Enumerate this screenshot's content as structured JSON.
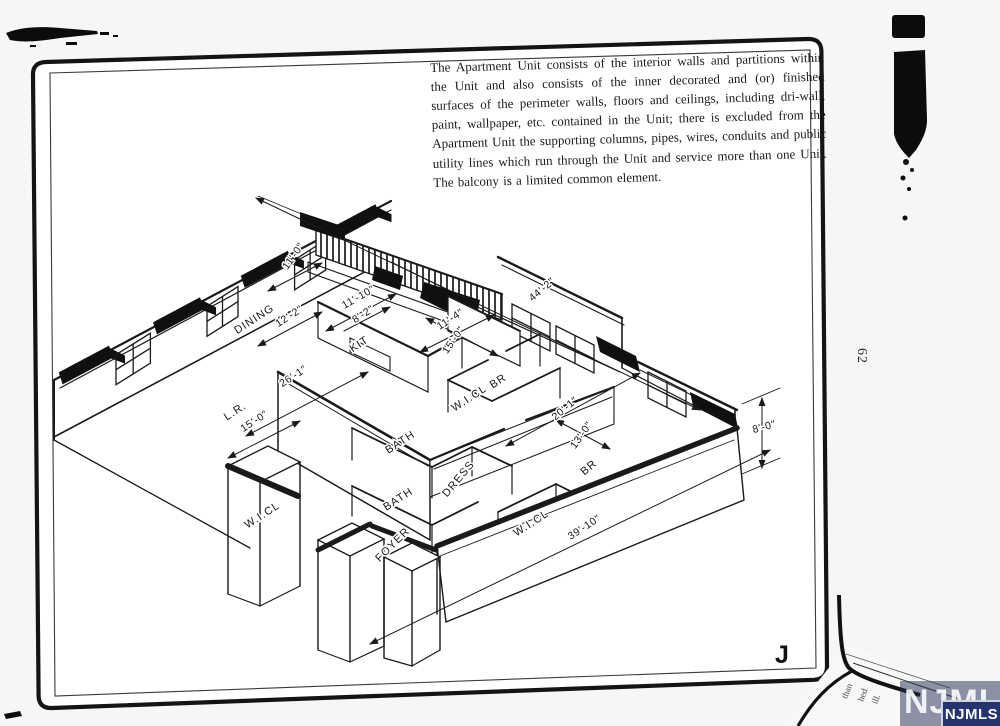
{
  "page": {
    "paragraph": "The Apartment Unit consists of the interior walls and partitions within the Unit and also consists of the inner decorated and (or) finished surfaces of the perimeter walls, floors and ceilings, including dri-wall, paint, wallpaper, etc. contained in the Unit; there is excluded from the Apartment Unit the supporting columns, pipes, wires, conduits and public utility lines which run through the Unit and service more than one Unit. The balcony is a limited common element.",
    "figure_label": "J",
    "page_number": "62"
  },
  "watermark": {
    "text": "NJMLS",
    "badge_color": "#25346e"
  },
  "overlap": {
    "fragments": [
      "than",
      "hed",
      "ill."
    ]
  },
  "plan": {
    "rooms": [
      {
        "text": "DINING"
      },
      {
        "text": "KIT"
      },
      {
        "text": "L.R."
      },
      {
        "text": "BR"
      },
      {
        "text": "W.I.CL"
      },
      {
        "text": "BATH"
      },
      {
        "text": "BATH"
      },
      {
        "text": "DRESS"
      },
      {
        "text": "FOYER"
      },
      {
        "text": "W.I.CL"
      },
      {
        "text": "BR"
      },
      {
        "text": "W.I.CL"
      }
    ],
    "dims": [
      {
        "text": "12'-2\""
      },
      {
        "text": "11'-10\""
      },
      {
        "text": "8'-2\""
      },
      {
        "text": "11'-0\""
      },
      {
        "text": "26'-1\""
      },
      {
        "text": "15'-0\""
      },
      {
        "text": "11'-4\""
      },
      {
        "text": "15'-0\""
      },
      {
        "text": "44'-2\""
      },
      {
        "text": "20'-1\""
      },
      {
        "text": "13'-0\""
      },
      {
        "text": "39'-10\""
      },
      {
        "text": "8'-0\""
      }
    ]
  }
}
